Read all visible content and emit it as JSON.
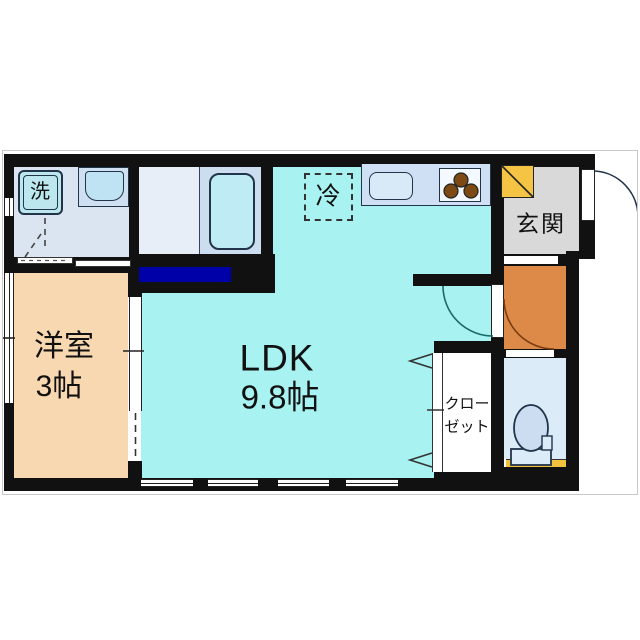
{
  "plan": {
    "type": "japanese-apartment-floor-plan",
    "labels": {
      "washing_machine": "洗",
      "refrigerator": "冷",
      "entrance": "玄関",
      "western_room": "洋室",
      "western_room_size": "3帖",
      "ldk": "LDK",
      "ldk_size": "9.8帖",
      "closet_line1": "クロー",
      "closet_line2": "ゼット"
    },
    "colors": {
      "wall": "#111111",
      "ldk_floor": "#a9f2f2",
      "western_room_floor": "#f7d8b0",
      "corridor_floor": "#dd8a49",
      "entrance_floor": "#d9d9d9",
      "washroom_floor": "#dbe5f1",
      "bathroom_floor": "#e7eef8",
      "bath_zone": "#ccddf0",
      "bathtub_fill": "#bfecf4",
      "kitchen_counter": "#cfe0f5",
      "toilet_floor": "#dcebf8",
      "accent_navy": "#0000a8",
      "accent_yellow": "#f5c445",
      "burner_brown": "#7c4a12",
      "frame_border": "#c9c9c9"
    }
  }
}
